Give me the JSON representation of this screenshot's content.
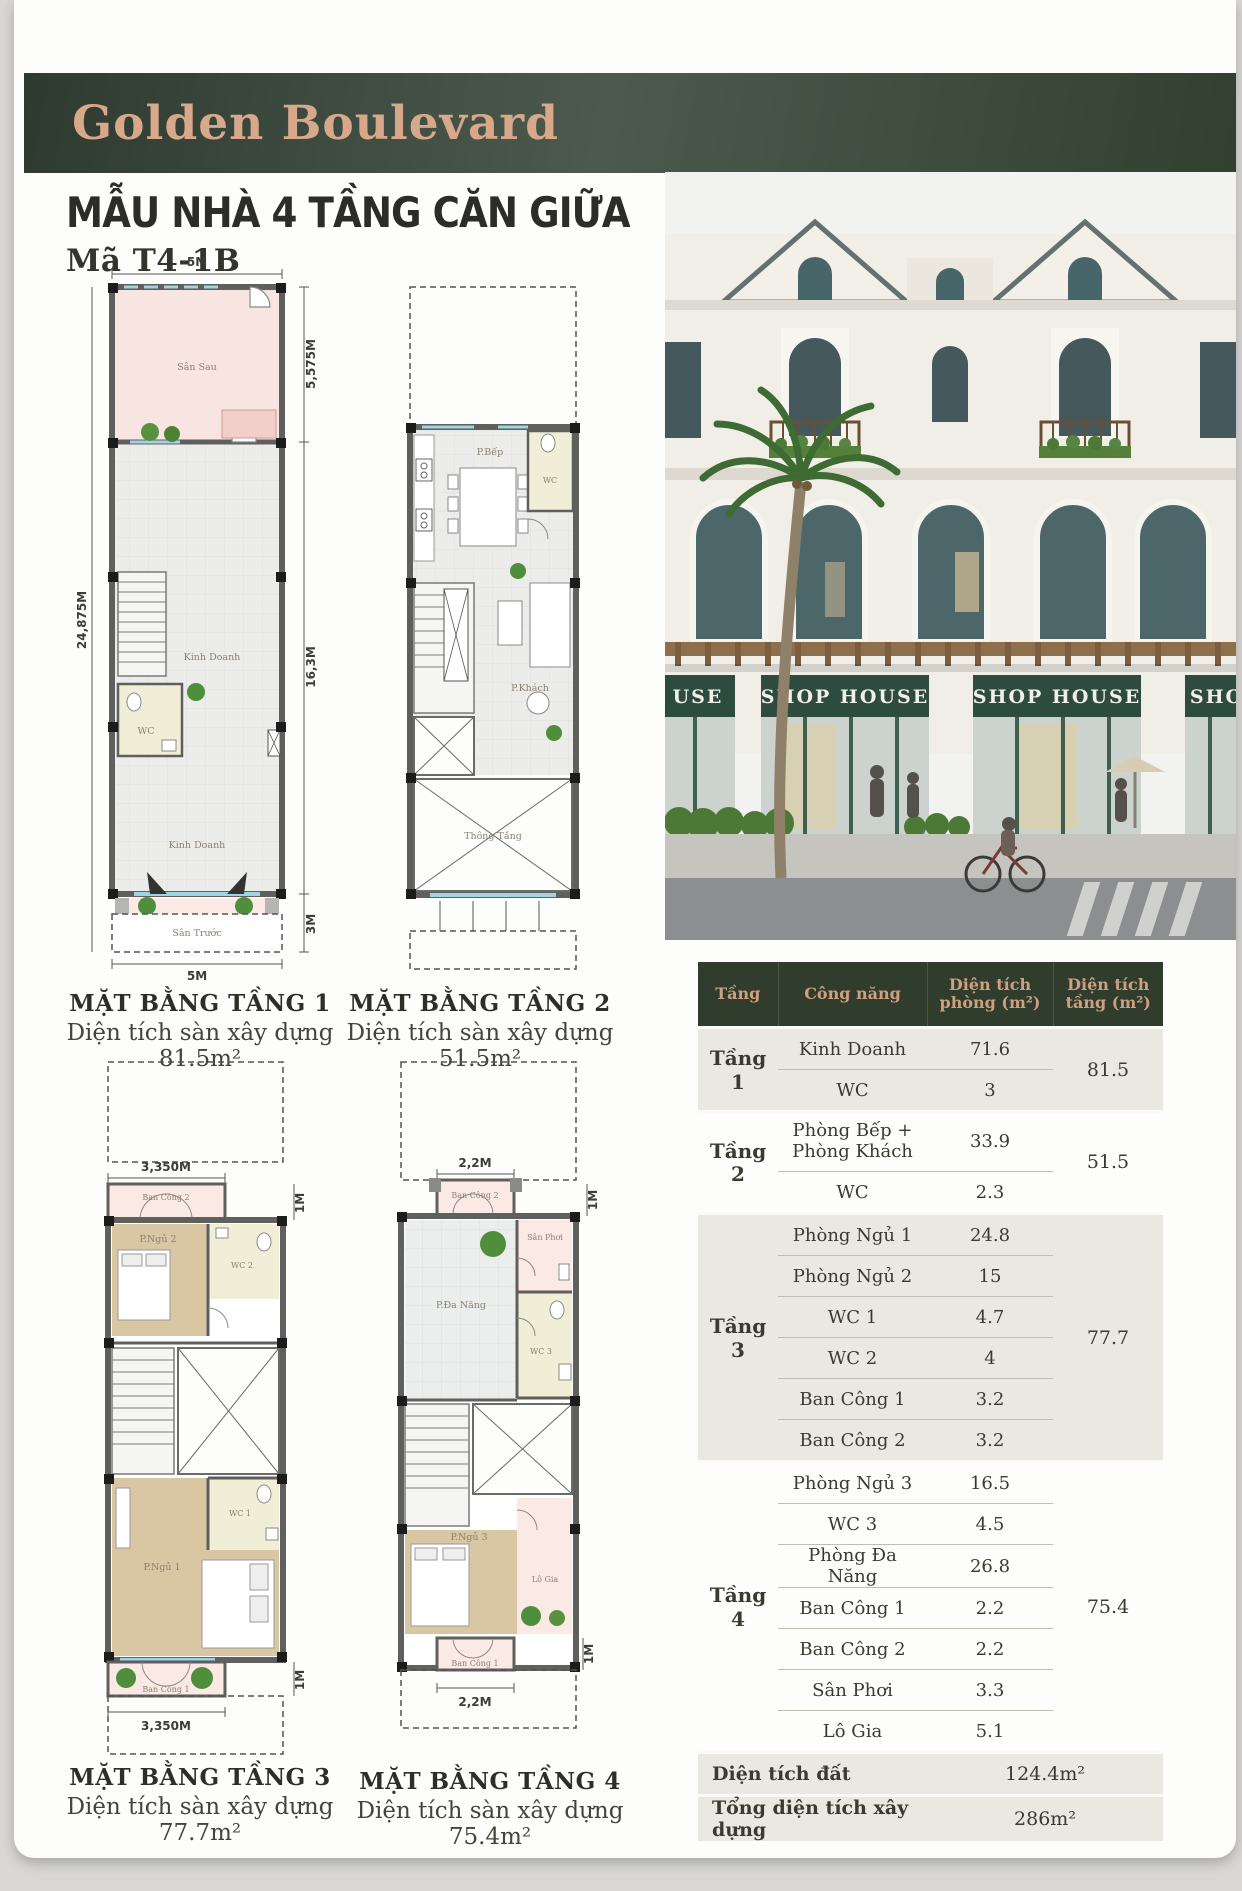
{
  "page": {
    "brand": "Golden Boulevard",
    "title": "MẪU NHÀ 4 TẦNG CĂN GIỮA",
    "code": "Mã T4-1B"
  },
  "colors": {
    "banner_green": "#36453a",
    "logo_tan": "#d8a88b",
    "table_header_green": "#303d2c",
    "table_header_text": "#cf9f82",
    "sign_green": "#2d4b3e",
    "group_row_bg": "#e9e9e2"
  },
  "plans": {
    "floor1": {
      "caption": "MẶT BẰNG TẦNG 1",
      "area": "Diện tích sàn xây dựng 81.5m²",
      "dims": {
        "top": "5M",
        "bottom": "5M",
        "left": "24,875M",
        "right_top": "5,575M",
        "right_mid": "16,3M",
        "right_bottom": "3M"
      },
      "rooms": {
        "san_sau": "Sân Sau",
        "kinh_doanh": "Kinh Doanh",
        "wc": "WC",
        "san_truoc": "Sân Trước"
      }
    },
    "floor2": {
      "caption": "MẶT BẰNG TẦNG 2",
      "area": "Diện tích sàn xây dựng 51.5m²",
      "rooms": {
        "bep": "P.Bếp",
        "wc": "WC",
        "khach": "P.Khách",
        "thong_tang": "Thông Tầng"
      }
    },
    "floor3": {
      "caption": "MẶT BẰNG TẦNG 3",
      "area": "Diện tích sàn xây dựng 77.7m²",
      "dims": {
        "top": "3,350M",
        "bottom": "3,350M",
        "right_top": "1M",
        "right_bottom": "1M"
      },
      "rooms": {
        "ban_cong_2": "Ban Công 2",
        "ngu_2": "P.Ngủ 2",
        "wc_2": "WC 2",
        "wc_1": "WC 1",
        "ngu_1": "P.Ngủ 1",
        "ban_cong_1": "Ban Công 1"
      }
    },
    "floor4": {
      "caption": "MẶT BẰNG TẦNG 4",
      "area": "Diện tích sàn xây dựng 75.4m²",
      "dims": {
        "top": "2,2M",
        "bottom": "2,2M",
        "right_top": "1M",
        "right_bottom": "1M"
      },
      "rooms": {
        "ban_cong_2": "Ban Công 2",
        "san_phoi": "Sân Phơi",
        "da_nang": "P.Đa Năng",
        "wc_3": "WC 3",
        "ngu_3": "P.Ngủ 3",
        "lo_gia": "Lô Gia",
        "ban_cong_1": "Ban Công 1"
      }
    }
  },
  "render": {
    "signs": [
      "USE",
      "SHOP HOUSE",
      "SHOP HOUSE",
      "SHO"
    ]
  },
  "area_table": {
    "headers": [
      "Tầng",
      "Công năng",
      "Diện tích phòng (m²)",
      "Diện tích tầng (m²)"
    ],
    "groups": [
      {
        "floor": "Tầng 1",
        "total": "81.5",
        "rows": [
          [
            "Kinh Doanh",
            "71.6"
          ],
          [
            "WC",
            "3"
          ]
        ]
      },
      {
        "floor": "Tầng 2",
        "total": "51.5",
        "rows": [
          [
            "Phòng Bếp + Phòng Khách",
            "33.9"
          ],
          [
            "WC",
            "2.3"
          ]
        ]
      },
      {
        "floor": "Tầng 3",
        "total": "77.7",
        "rows": [
          [
            "Phòng Ngủ 1",
            "24.8"
          ],
          [
            "Phòng Ngủ 2",
            "15"
          ],
          [
            "WC 1",
            "4.7"
          ],
          [
            "WC 2",
            "4"
          ],
          [
            "Ban Công 1",
            "3.2"
          ],
          [
            "Ban Công 2",
            "3.2"
          ]
        ]
      },
      {
        "floor": "Tầng 4",
        "total": "75.4",
        "rows": [
          [
            "Phòng Ngủ 3",
            "16.5"
          ],
          [
            "WC 3",
            "4.5"
          ],
          [
            "Phòng Đa Năng",
            "26.8"
          ],
          [
            "Ban Công 1",
            "2.2"
          ],
          [
            "Ban Công 2",
            "2.2"
          ],
          [
            "Sân Phơi",
            "3.3"
          ],
          [
            "Lô Gia",
            "5.1"
          ]
        ]
      }
    ],
    "footer": [
      {
        "label": "Diện tích đất",
        "value": "124.4m²"
      },
      {
        "label": "Tổng diện tích xây dựng",
        "value": "286m²"
      }
    ]
  }
}
